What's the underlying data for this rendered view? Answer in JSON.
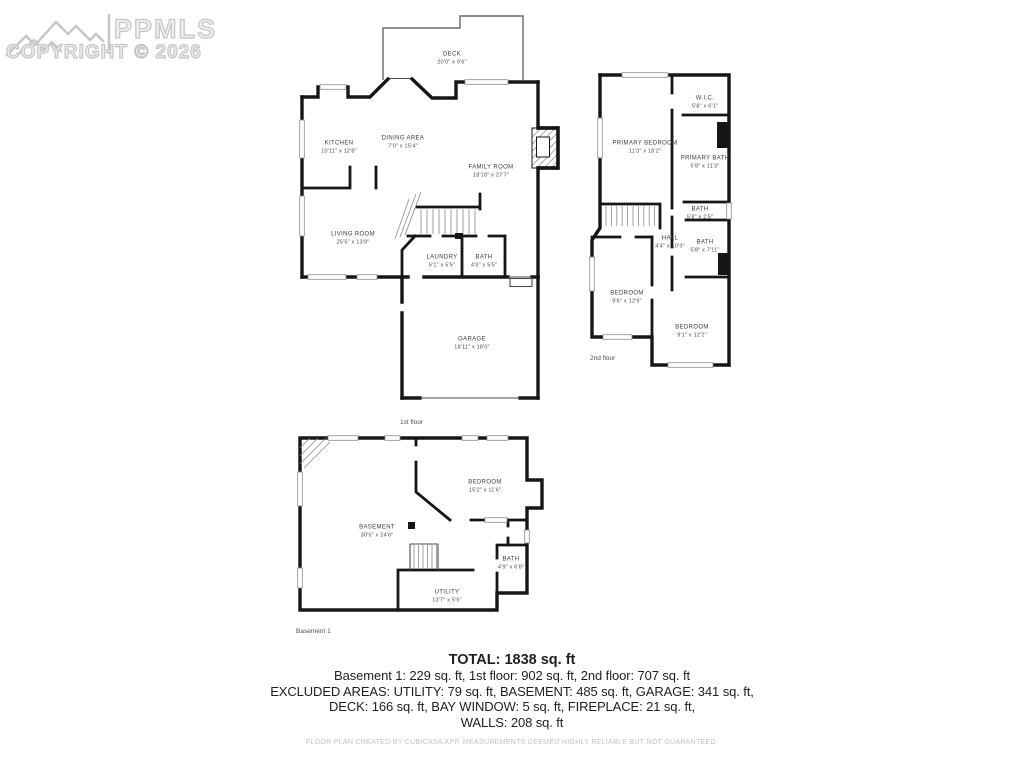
{
  "watermark": {
    "brand": "PPMLS",
    "copyright": "COPYRIGHT © 2026"
  },
  "floors": {
    "first": {
      "label": "1st floor",
      "rooms": {
        "deck": {
          "name": "DECK",
          "dims": "20'0\" x 9'6\""
        },
        "kitchen": {
          "name": "KITCHEN",
          "dims": "10'11\" x 12'8\""
        },
        "dining": {
          "name": "DINING AREA",
          "dims": "7'0\" x 15'4\""
        },
        "family": {
          "name": "FAMILY ROOM",
          "dims": "18'10\" x 27'7\""
        },
        "living": {
          "name": "LIVING ROOM",
          "dims": "25'5\" x 13'9\""
        },
        "laundry": {
          "name": "LAUNDRY",
          "dims": "6'1\" x 5'5\""
        },
        "bath": {
          "name": "BATH",
          "dims": "4'9\" x 5'5\""
        },
        "garage": {
          "name": "GARAGE",
          "dims": "18'11\" x 18'0\""
        }
      }
    },
    "second": {
      "label": "2nd floor",
      "rooms": {
        "primary_bedroom": {
          "name": "PRIMARY BEDROOM",
          "dims": "11'3\" x 18'2\""
        },
        "wic": {
          "name": "W.I.C.",
          "dims": "5'8\" x 6'1\""
        },
        "primary_bath": {
          "name": "PRIMARY BATH",
          "dims": "5'8\" x 11'3\""
        },
        "bath_small": {
          "name": "BATH",
          "dims": "5'8\" x 2'5\""
        },
        "hall": {
          "name": "HALL",
          "dims": "4'4\" x 10'3\""
        },
        "bath": {
          "name": "BATH",
          "dims": "5'8\" x 7'11\""
        },
        "bedroom_left": {
          "name": "BEDROOM",
          "dims": "9'6\" x 12'9\""
        },
        "bedroom_right": {
          "name": "BEDROOM",
          "dims": "9'1\" x 12'2\""
        }
      }
    },
    "basement": {
      "label": "Basement 1",
      "rooms": {
        "bedroom": {
          "name": "BEDROOM",
          "dims": "15'2\" x 11'6\""
        },
        "basement": {
          "name": "BASEMENT",
          "dims": "30'5\" x 24'6\""
        },
        "bath": {
          "name": "BATH",
          "dims": "4'9\" x 6'8\""
        },
        "utility": {
          "name": "UTILITY",
          "dims": "13'7\" x 5'5\""
        }
      }
    }
  },
  "summary": {
    "total": "TOTAL: 1838 sq. ft",
    "lines": [
      "Basement 1: 229 sq. ft, 1st floor: 902 sq. ft, 2nd floor: 707 sq. ft",
      "EXCLUDED AREAS: UTILITY: 79 sq. ft, BASEMENT: 485 sq. ft, GARAGE: 341 sq. ft,",
      "DECK: 166 sq. ft, BAY WINDOW: 5 sq. ft, FIREPLACE: 21 sq. ft,",
      "WALLS: 208 sq. ft"
    ],
    "footer": "FLOOR PLAN CREATED BY CUBICASA APP. MEASUREMENTS DEEMED HIGHLY RELIABLE BUT NOT GUARANTEED."
  }
}
